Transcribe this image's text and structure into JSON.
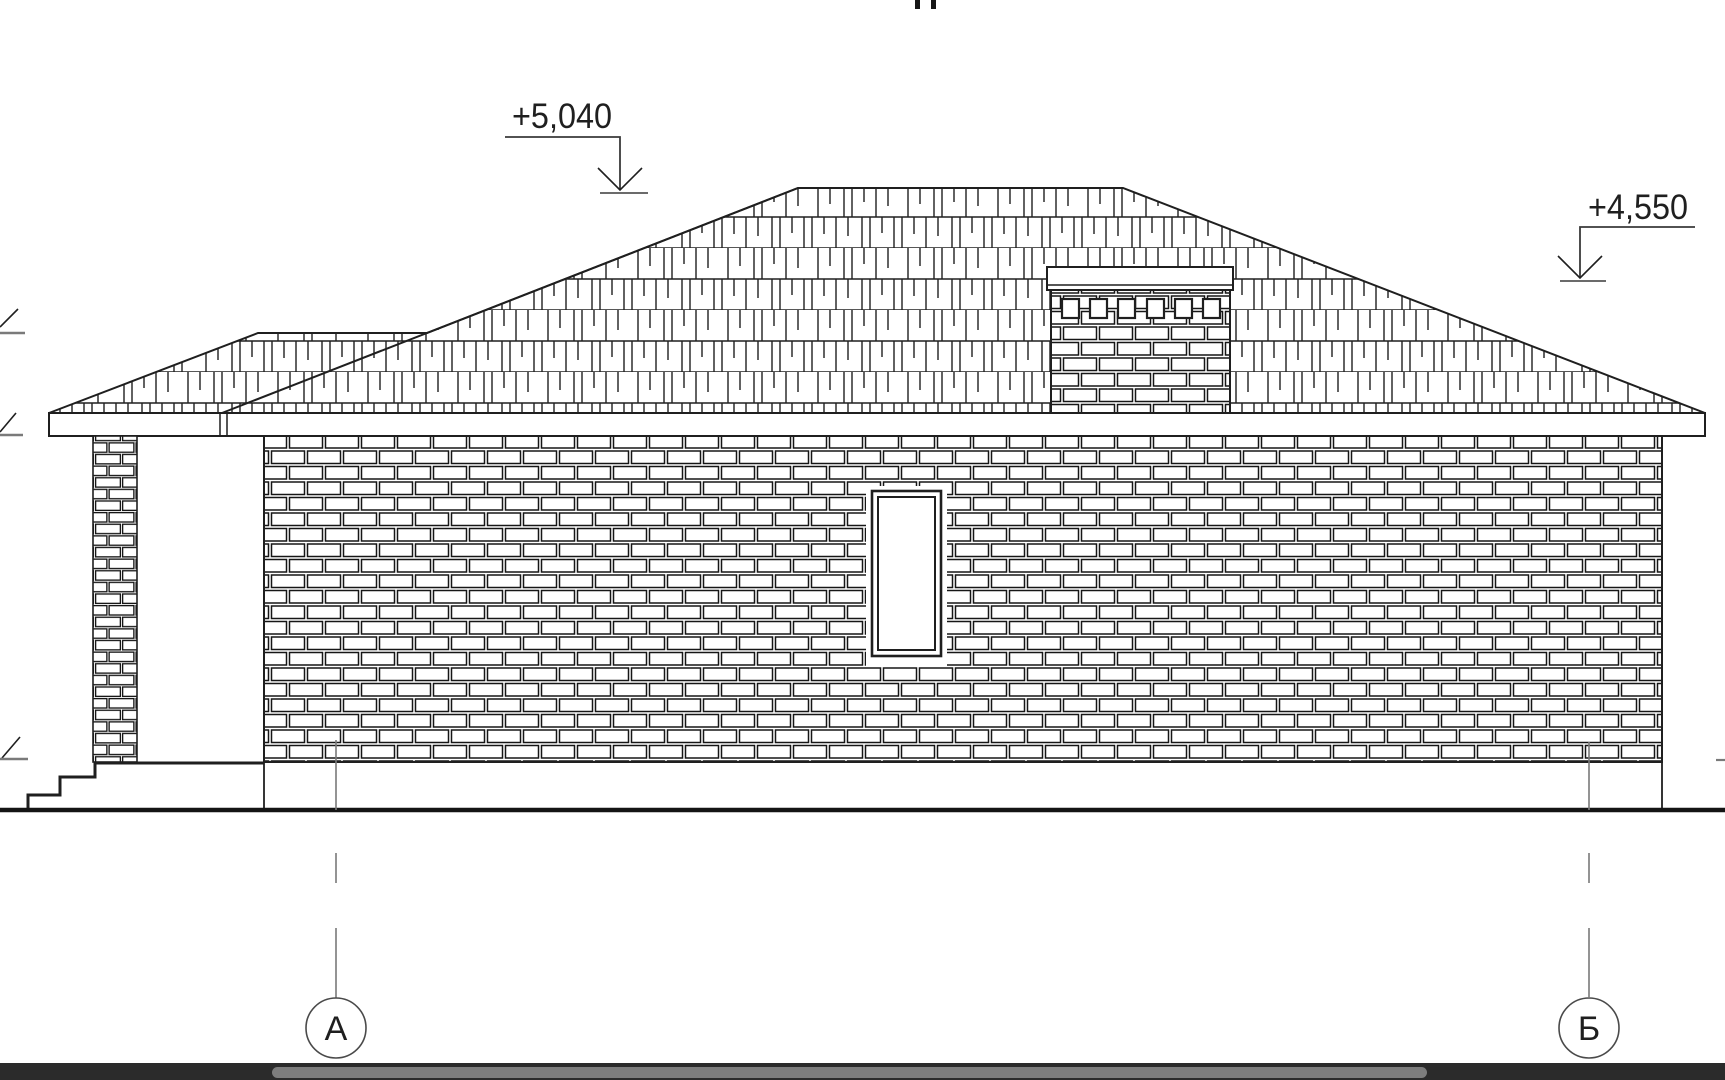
{
  "drawing": {
    "kind": "architectural side elevation (facade) line drawing",
    "elevation_marks": [
      {
        "id": "ridge-level",
        "value": "+5,040"
      },
      {
        "id": "eave-level",
        "value": "+4,550"
      }
    ],
    "axes": [
      {
        "id": "axis-a",
        "label": "А"
      },
      {
        "id": "axis-b",
        "label": "Б"
      }
    ],
    "colors": {
      "line": "#1f1f1f",
      "axis_grey": "#7a7a7a",
      "paper": "#ffffff"
    }
  },
  "viewer": {
    "scrollbar": {
      "orientation": "horizontal",
      "track_color": "#2b2b2b",
      "thumb_color": "#7d7d7d"
    }
  }
}
